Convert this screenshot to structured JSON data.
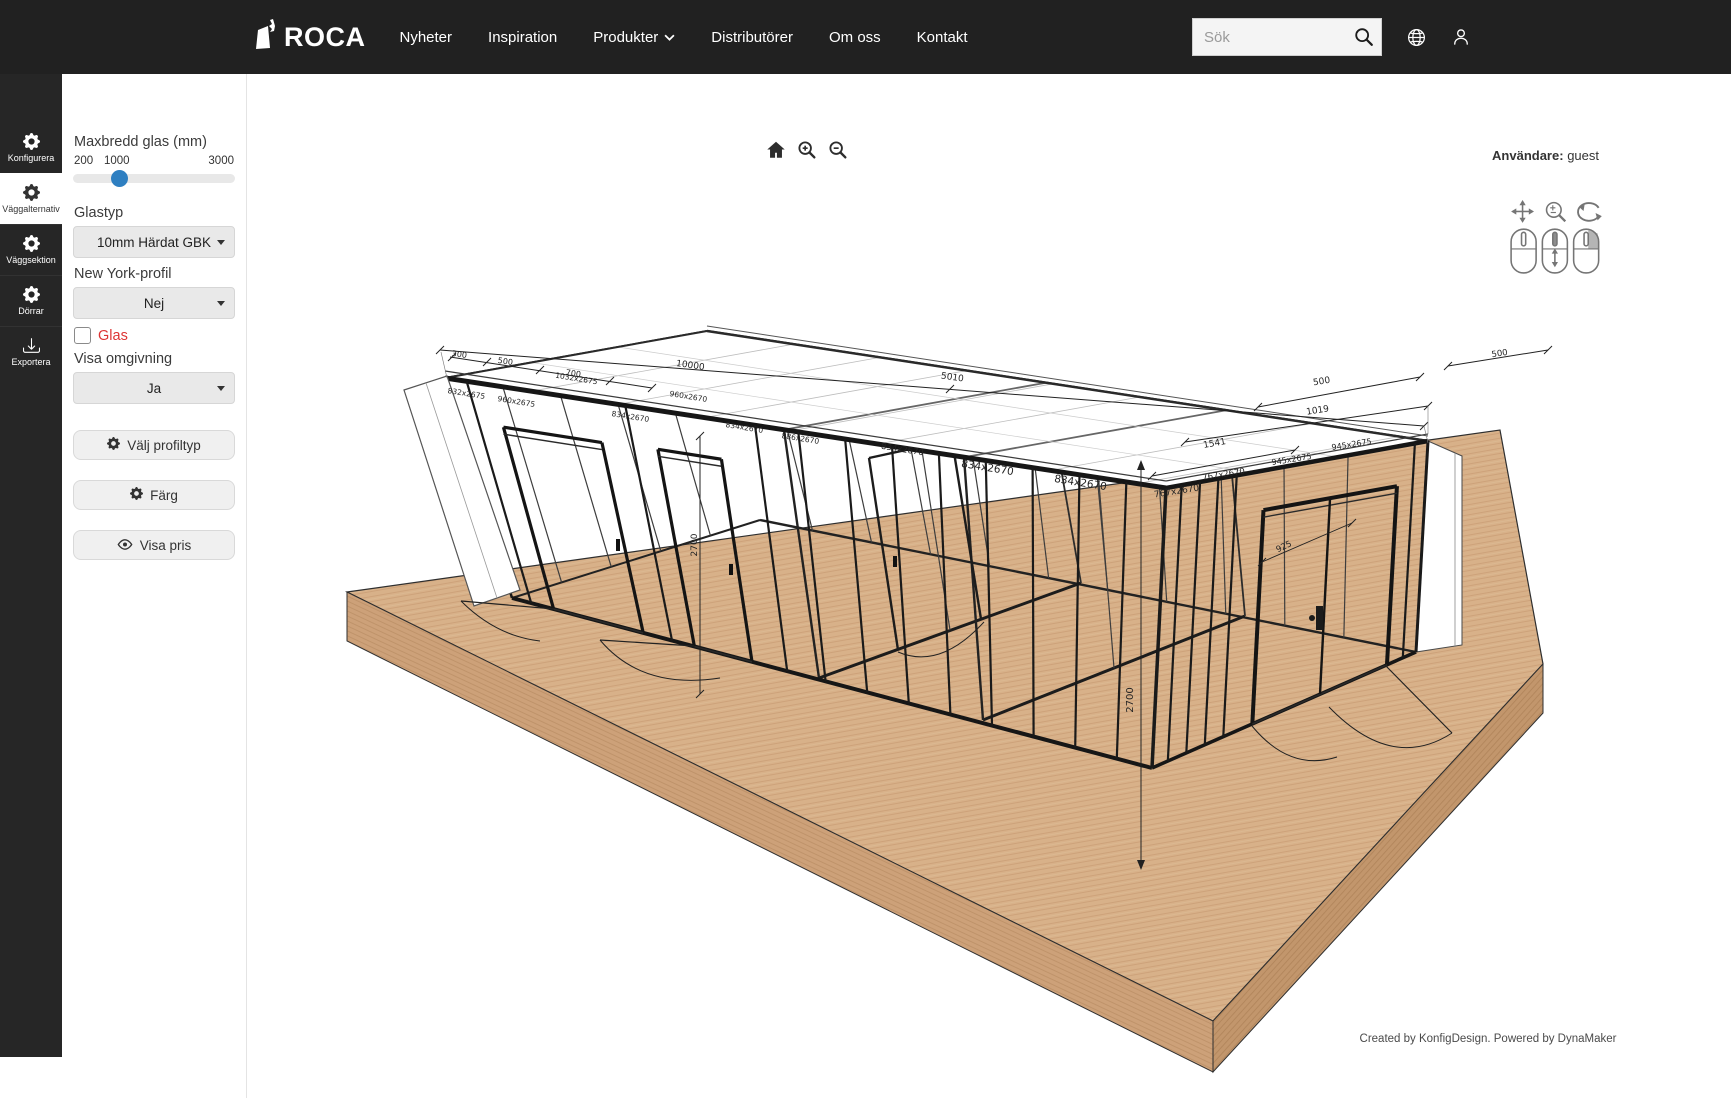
{
  "navbar": {
    "brand": "ROCA",
    "links": [
      {
        "label": "Nyheter"
      },
      {
        "label": "Inspiration"
      },
      {
        "label": "Produkter",
        "has_dropdown": true
      },
      {
        "label": "Distributörer"
      },
      {
        "label": "Om oss"
      },
      {
        "label": "Kontakt"
      }
    ],
    "search_placeholder": "Sök"
  },
  "sidebar": {
    "items": [
      {
        "label": "Konfigurera",
        "icon": "gear",
        "active": false
      },
      {
        "label": "Väggalternativ",
        "icon": "gear",
        "active": true
      },
      {
        "label": "Väggsektion",
        "icon": "gear",
        "active": false
      },
      {
        "label": "Dörrar",
        "icon": "gear",
        "active": false
      },
      {
        "label": "Exportera",
        "icon": "download",
        "active": false
      }
    ]
  },
  "panel": {
    "slider": {
      "label": "Maxbredd glas (mm)",
      "min_label": "200",
      "value_label": "1000",
      "max_label": "3000",
      "min": 200,
      "max": 3000,
      "value": 1000
    },
    "glastyp": {
      "label": "Glastyp",
      "value": "10mm Härdat GBK"
    },
    "ny_profil": {
      "label": "New York-profil",
      "value": "Nej"
    },
    "glas_checkbox": {
      "label": "Glas",
      "checked": false
    },
    "omgivning": {
      "label": "Visa omgivning",
      "value": "Ja"
    },
    "buttons": [
      {
        "label": "Välj profiltyp",
        "icon": "gear"
      },
      {
        "label": "Färg",
        "icon": "gear"
      },
      {
        "label": "Visa pris",
        "icon": "eye"
      }
    ]
  },
  "viewport": {
    "toolbar_icons": [
      "home",
      "zoom-in",
      "zoom-out"
    ],
    "user_label": "Användare:",
    "user_value": "guest",
    "mouse_help": [
      "pan",
      "zoom",
      "rotate"
    ],
    "credit": "Created by KonfigDesign. Powered by DynaMaker",
    "scene_labels": [
      {
        "text": "300",
        "x": 459,
        "y": 357,
        "r": 8,
        "s": 8
      },
      {
        "text": "500",
        "x": 505,
        "y": 364,
        "r": 8,
        "s": 8
      },
      {
        "text": "700",
        "x": 573,
        "y": 376,
        "r": 8,
        "s": 8
      },
      {
        "text": "10000",
        "x": 690,
        "y": 368,
        "r": 8,
        "s": 9
      },
      {
        "text": "5010",
        "x": 952,
        "y": 380,
        "r": 8,
        "s": 9
      },
      {
        "text": "500",
        "x": 1322,
        "y": 384,
        "r": -9,
        "s": 9
      },
      {
        "text": "500",
        "x": 1500,
        "y": 356,
        "r": -9,
        "s": 8.5
      },
      {
        "text": "1019",
        "x": 1318,
        "y": 413,
        "r": -9,
        "s": 9
      },
      {
        "text": "1541",
        "x": 1215,
        "y": 446,
        "r": -10,
        "s": 9
      },
      {
        "text": "2700",
        "x": 697,
        "y": 545,
        "r": -90,
        "s": 9
      },
      {
        "text": "2700",
        "x": 1133,
        "y": 700,
        "r": -90,
        "s": 10
      },
      {
        "text": "925",
        "x": 1285,
        "y": 549,
        "r": -26,
        "s": 8.5
      },
      {
        "text": "832x2675",
        "x": 466,
        "y": 396,
        "r": 9,
        "s": 7.5
      },
      {
        "text": "960x2675",
        "x": 516,
        "y": 404,
        "r": 9,
        "s": 7.5
      },
      {
        "text": "1032x2675",
        "x": 576,
        "y": 381,
        "r": 9,
        "s": 7.5
      },
      {
        "text": "834x2670",
        "x": 630,
        "y": 419,
        "r": 9,
        "s": 7.5
      },
      {
        "text": "960x2670",
        "x": 688,
        "y": 399,
        "r": 9,
        "s": 7.5
      },
      {
        "text": "834x2670",
        "x": 744,
        "y": 430,
        "r": 9,
        "s": 7.5
      },
      {
        "text": "886x2670",
        "x": 800,
        "y": 441,
        "r": 9,
        "s": 7.5
      },
      {
        "text": "834x2670",
        "x": 902,
        "y": 452,
        "r": 9,
        "s": 8.5
      },
      {
        "text": "834x2670",
        "x": 987,
        "y": 471,
        "r": 9,
        "s": 10.5
      },
      {
        "text": "834x2670",
        "x": 1080,
        "y": 486,
        "r": 9,
        "s": 10.5
      },
      {
        "text": "767x2670",
        "x": 1177,
        "y": 494,
        "r": -9,
        "s": 9
      },
      {
        "text": "767x2670",
        "x": 1224,
        "y": 477,
        "r": -9,
        "s": 8.5
      },
      {
        "text": "945x2675",
        "x": 1292,
        "y": 462,
        "r": -9,
        "s": 8
      },
      {
        "text": "945x2675",
        "x": 1352,
        "y": 447,
        "r": -9,
        "s": 8
      }
    ]
  },
  "colors": {
    "navbar_bg": "#212121",
    "rail_bg": "#262626",
    "slider_thumb": "#2e7fc1",
    "glas_label": "#dd3434",
    "wood_top": "#d8b189"
  }
}
